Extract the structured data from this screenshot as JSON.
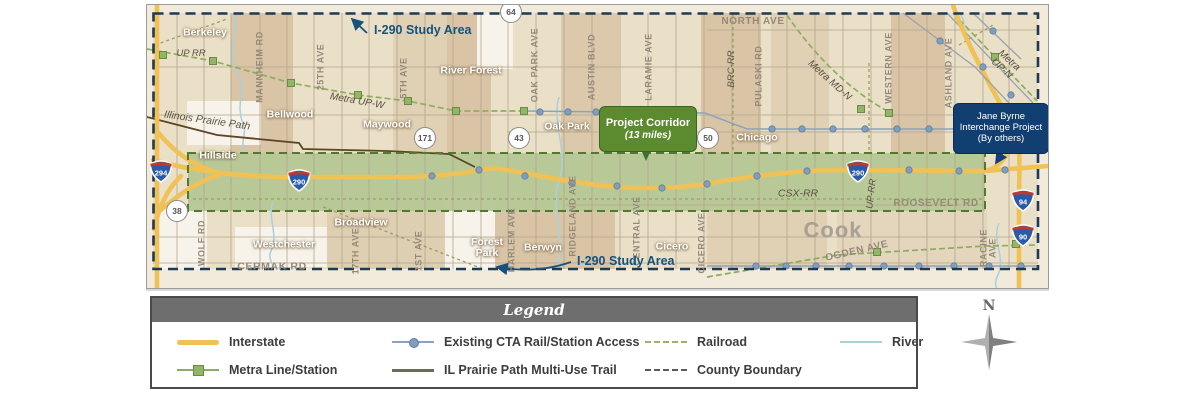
{
  "colors": {
    "interstate_yellow": "#F0C155",
    "metra_green": "#8CAE60",
    "cta_blue": "#7F9EC0",
    "corridor_green": "#B4C693",
    "boundary_navy": "#1D3A52",
    "trail_brown": "#5D4423",
    "railroad_olive": "#99A05C",
    "river_blue": "#A9D0DD",
    "study_label_blue": "#16527E",
    "project_box_green": "#5C8B2F",
    "jane_byrne_navy": "#123F72"
  },
  "map": {
    "annotations": {
      "study_area_top": "I-290 Study Area",
      "study_area_bottom": "I-290 Study Area",
      "project_corridor_line1": "Project Corridor",
      "project_corridor_line2": "(13 miles)",
      "jane_byrne_line1": "Jane Byrne",
      "jane_byrne_line2": "Interchange Project",
      "jane_byrne_line3": "(By others)"
    },
    "labels": [
      {
        "id": "berkeley",
        "text": "Berkeley",
        "kind": "city",
        "x": 58,
        "y": 28
      },
      {
        "id": "up-rr",
        "text": "UP RR",
        "kind": "rail",
        "x": 44,
        "y": 49
      },
      {
        "id": "mannheim-rd",
        "text": "MANNHEIM RD",
        "kind": "roadv",
        "x": 113,
        "y": 62
      },
      {
        "id": "25th-ave",
        "text": "25TH AVE",
        "kind": "roadv",
        "x": 174,
        "y": 62
      },
      {
        "id": "5th-ave",
        "text": "5TH AVE",
        "kind": "roadv",
        "x": 257,
        "y": 73
      },
      {
        "id": "river-forest",
        "text": "River Forest",
        "kind": "city",
        "x": 324,
        "y": 66
      },
      {
        "id": "metra-up-w",
        "text": "Metra UP-W",
        "kind": "transit",
        "x": 210,
        "y": 97,
        "rot": 10
      },
      {
        "id": "illinois-prairie-path",
        "text": "Illinois Prairie Path",
        "kind": "rail",
        "x": 60,
        "y": 116,
        "rot": 8,
        "size": 10.5
      },
      {
        "id": "bellwood",
        "text": "Bellwood",
        "kind": "city",
        "x": 143,
        "y": 110
      },
      {
        "id": "maywood",
        "text": "Maywood",
        "kind": "city",
        "x": 240,
        "y": 120
      },
      {
        "id": "hillside",
        "text": "Hillside",
        "kind": "city",
        "x": 71,
        "y": 151
      },
      {
        "id": "wolf-rd",
        "text": "WOLF RD",
        "kind": "roadv",
        "x": 55,
        "y": 238
      },
      {
        "id": "westchester",
        "text": "Westchester",
        "kind": "city",
        "x": 137,
        "y": 240
      },
      {
        "id": "cermak-rd",
        "text": "CERMAK RD",
        "kind": "road",
        "x": 125,
        "y": 262,
        "size": 10.5
      },
      {
        "id": "broadview",
        "text": "Broadview",
        "kind": "city",
        "x": 214,
        "y": 218
      },
      {
        "id": "17th-ave",
        "text": "17TH AVE",
        "kind": "roadv",
        "x": 209,
        "y": 246
      },
      {
        "id": "1st-ave",
        "text": "1ST AVE",
        "kind": "roadv",
        "x": 272,
        "y": 246
      },
      {
        "id": "forest-park",
        "text": "Forest\nPark",
        "kind": "city",
        "x": 340,
        "y": 243
      },
      {
        "id": "harlem-ave",
        "text": "HARLEM AVE",
        "kind": "roadv",
        "x": 365,
        "y": 235
      },
      {
        "id": "berwyn",
        "text": "Berwyn",
        "kind": "city",
        "x": 396,
        "y": 243
      },
      {
        "id": "ridgeland-ave",
        "text": "RIDGELAND AVE",
        "kind": "roadv",
        "x": 426,
        "y": 211
      },
      {
        "id": "central-ave",
        "text": "CENTRAL AVE",
        "kind": "roadv",
        "x": 490,
        "y": 226
      },
      {
        "id": "cicero",
        "text": "Cicero",
        "kind": "city",
        "x": 525,
        "y": 242
      },
      {
        "id": "cicero-ave",
        "text": "CICERO AVE",
        "kind": "roadv",
        "x": 555,
        "y": 238
      },
      {
        "id": "oak-park",
        "text": "Oak Park",
        "kind": "city",
        "x": 420,
        "y": 122
      },
      {
        "id": "austin-blvd",
        "text": "AUSTIN BLVD",
        "kind": "roadv",
        "x": 445,
        "y": 62
      },
      {
        "id": "oak-park-ave",
        "text": "OAK PARK AVE",
        "kind": "roadv",
        "x": 388,
        "y": 60
      },
      {
        "id": "laramie-ave",
        "text": "LARAMIE AVE",
        "kind": "roadv",
        "x": 502,
        "y": 62
      },
      {
        "id": "north-ave",
        "text": "NORTH AVE",
        "kind": "road",
        "x": 606,
        "y": 17,
        "size": 10
      },
      {
        "id": "brc-rr",
        "text": "BRC-RR",
        "kind": "railv",
        "x": 585,
        "y": 64
      },
      {
        "id": "pulaski-rd",
        "text": "PULASKI RD",
        "kind": "roadv",
        "x": 612,
        "y": 71
      },
      {
        "id": "metra-md-n",
        "text": "Metra MD-N",
        "kind": "transit",
        "x": 682,
        "y": 76,
        "rot": 42
      },
      {
        "id": "western-ave",
        "text": "WESTERN AVE",
        "kind": "roadv",
        "x": 742,
        "y": 63
      },
      {
        "id": "ashland-ave",
        "text": "ASHLAND AVE",
        "kind": "roadv",
        "x": 802,
        "y": 68
      },
      {
        "id": "metra-up-n",
        "text": "Metra UP-N",
        "kind": "transit",
        "x": 858,
        "y": 60,
        "rot": 42
      },
      {
        "id": "chicago",
        "text": "Chicago",
        "kind": "city",
        "x": 610,
        "y": 133
      },
      {
        "id": "csx-rr",
        "text": "CSX-RR",
        "kind": "rail",
        "x": 651,
        "y": 189,
        "size": 10.5
      },
      {
        "id": "up-rr-vert",
        "text": "UP-RR",
        "kind": "railv",
        "x": 725,
        "y": 189,
        "rot": -83
      },
      {
        "id": "roosevelt-rd",
        "text": "ROOSEVELT RD",
        "kind": "road",
        "x": 789,
        "y": 199,
        "size": 10
      },
      {
        "id": "cook-county",
        "text": "Cook",
        "kind": "county",
        "x": 686,
        "y": 225
      },
      {
        "id": "ogden-ave",
        "text": "OGDEN AVE",
        "kind": "road",
        "x": 710,
        "y": 247,
        "rot": -13,
        "size": 10
      },
      {
        "id": "racine-ave",
        "text": "RACINE AVE",
        "kind": "roadv",
        "x": 842,
        "y": 243
      }
    ],
    "interstate_shields": [
      {
        "id": "i294",
        "text": "294",
        "x": 14,
        "y": 166
      },
      {
        "id": "i290-west",
        "text": "290",
        "x": 152,
        "y": 175
      },
      {
        "id": "i290-east",
        "text": "290",
        "x": 711,
        "y": 166
      },
      {
        "id": "i94",
        "text": "94",
        "x": 876,
        "y": 195
      },
      {
        "id": "i90",
        "text": "90",
        "x": 876,
        "y": 230
      }
    ],
    "route_shields": [
      {
        "id": "il64",
        "text": "64",
        "x": 364,
        "y": 7
      },
      {
        "id": "il171",
        "text": "171",
        "x": 278,
        "y": 133
      },
      {
        "id": "il43",
        "text": "43",
        "x": 372,
        "y": 133
      },
      {
        "id": "il50",
        "text": "50",
        "x": 561,
        "y": 133
      },
      {
        "id": "il38",
        "text": "38",
        "x": 30,
        "y": 206
      }
    ]
  },
  "legend": {
    "title": "Legend",
    "items": [
      {
        "id": "interstate",
        "label": "Interstate",
        "swatch": "interstate",
        "col": 0,
        "row": 0
      },
      {
        "id": "metra",
        "label": "Metra Line/Station",
        "swatch": "metra",
        "col": 0,
        "row": 1
      },
      {
        "id": "cta",
        "label": "Existing CTA Rail/Station Access",
        "swatch": "cta",
        "col": 1,
        "row": 0
      },
      {
        "id": "trail",
        "label": "IL Prairie Path Multi-Use Trail",
        "swatch": "trail",
        "col": 1,
        "row": 1
      },
      {
        "id": "railroad",
        "label": "Railroad",
        "swatch": "railroad",
        "col": 2,
        "row": 0
      },
      {
        "id": "county",
        "label": "County Boundary",
        "swatch": "county",
        "col": 2,
        "row": 1
      },
      {
        "id": "river",
        "label": "River",
        "swatch": "river",
        "col": 3,
        "row": 0
      }
    ]
  },
  "compass": {
    "north": "N"
  }
}
